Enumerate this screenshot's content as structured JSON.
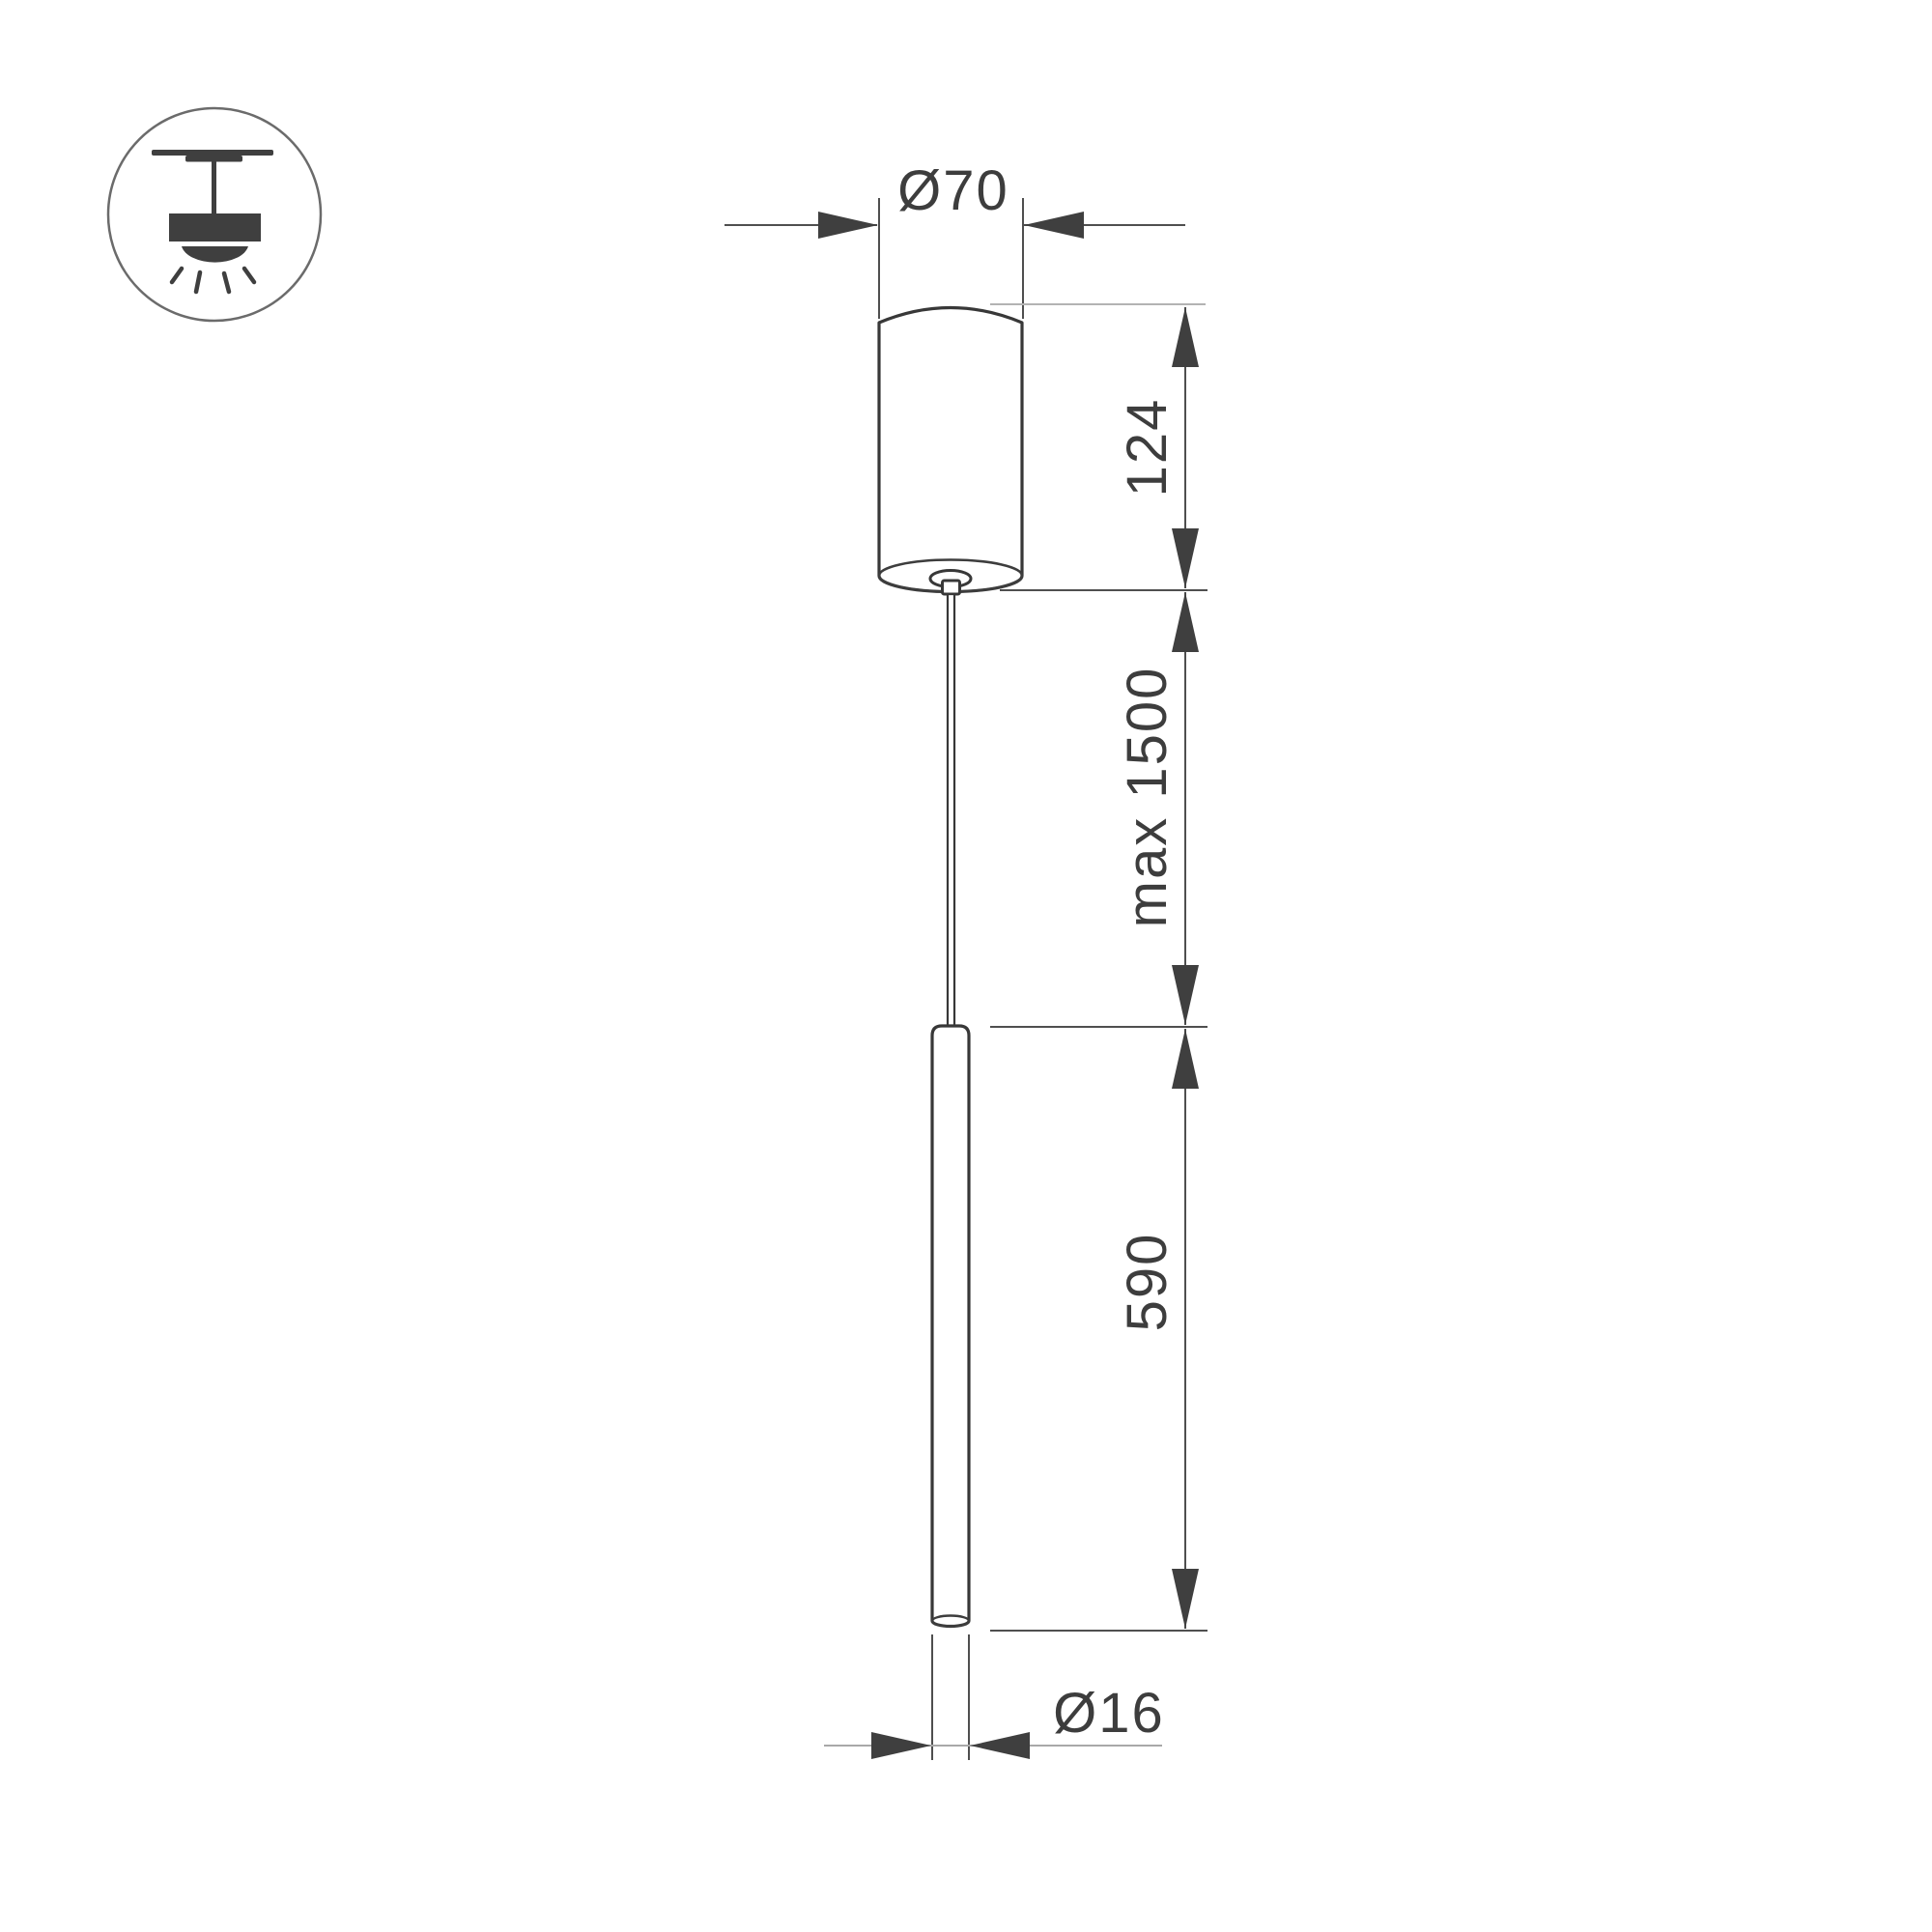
{
  "page": {
    "background_color": "#ffffff",
    "line_color": "#3f3f3f",
    "dimension_line_color": "#4f4f4f",
    "light_extension_line_color": "#b3b3b3",
    "text_color": "#3d3d3d"
  },
  "legend": {
    "icon": "ceiling-pendant-light-icon"
  },
  "drawing": {
    "subject": "pendant light fixture side view with canopy, suspension wire and tube lamp"
  },
  "dimensions": {
    "canopy_diameter": "Ø70",
    "canopy_height": "124",
    "suspension_length": "max 1500",
    "tube_length": "590",
    "tube_diameter": "Ø16"
  }
}
